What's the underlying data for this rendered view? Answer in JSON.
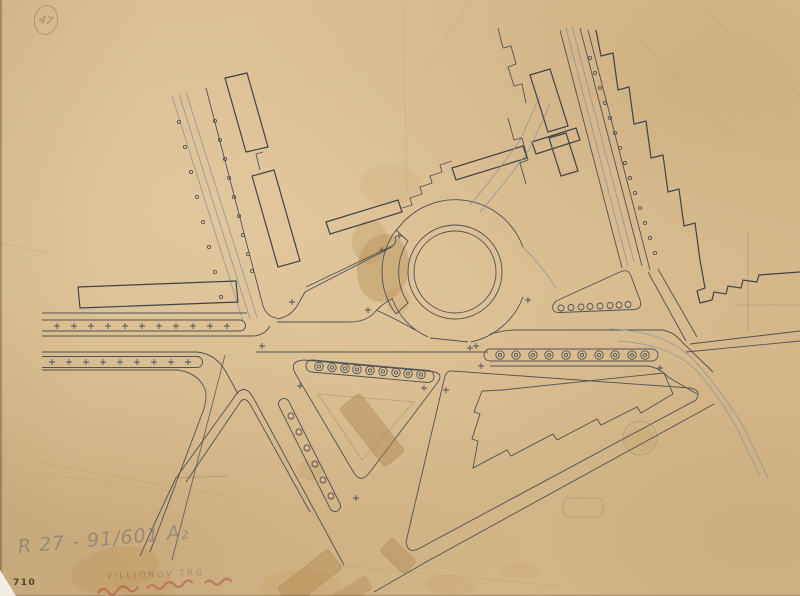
{
  "annotations": {
    "corner_mark": "47",
    "print_number": "710",
    "reference_number": "R 27 - 91/601 A₂",
    "caption_pencil": "VILLJONOV TRG"
  },
  "colors": {
    "paper": "#d9bc8f",
    "ink": "#4e5357",
    "ink_light": "#8d979c",
    "pencil": "#8f8472",
    "print_ink": "#53422c",
    "red_ink": "#b0483a"
  }
}
